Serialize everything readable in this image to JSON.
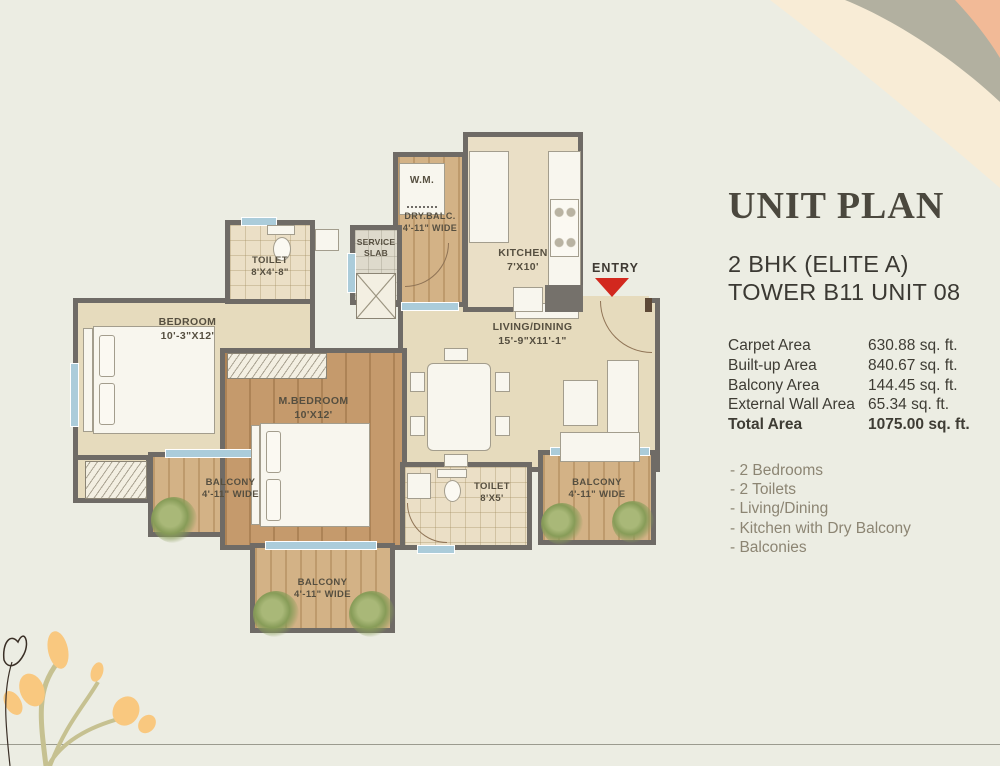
{
  "panel": {
    "title": "UNIT PLAN",
    "subtitle_line1": "2 BHK (ELITE A)",
    "subtitle_line2": "TOWER B11 UNIT 08",
    "areas": [
      {
        "label": "Carpet Area",
        "value": "630.88 sq. ft."
      },
      {
        "label": "Built-up Area",
        "value": "840.67 sq. ft."
      },
      {
        "label": "Balcony Area",
        "value": "144.45 sq. ft."
      },
      {
        "label": "External Wall Area",
        "value": "65.34 sq. ft."
      },
      {
        "label": "Total Area",
        "value": "1075.00 sq. ft."
      }
    ],
    "features": [
      "- 2 Bedrooms",
      "- 2 Toilets",
      "- Living/Dining",
      "- Kitchen with Dry Balcony",
      "- Balconies"
    ]
  },
  "plan": {
    "entry_label": "ENTRY",
    "rooms": {
      "bedroom": {
        "name": "BEDROOM",
        "size": "10'-3\"X12'"
      },
      "mbedroom": {
        "name": "M.BEDROOM",
        "size": "10'X12'"
      },
      "living": {
        "name": "LIVING/DINING",
        "size": "15'-9\"X11'-1\""
      },
      "kitchen": {
        "name": "KITCHEN",
        "size": "7'X10'"
      },
      "toilet1": {
        "name": "TOILET",
        "size": "8'X4'-8\""
      },
      "toilet2": {
        "name": "TOILET",
        "size": "8'X5'"
      },
      "drybalc": {
        "name": "DRY.BALC.",
        "size": "4'-11\" WIDE"
      },
      "service_line1": "SERVICE",
      "service_line2": "SLAB",
      "wm": "W.M.",
      "balcony_left": {
        "name": "BALCONY",
        "size": "4'-11\" WIDE"
      },
      "balcony_bottom": {
        "name": "BALCONY",
        "size": "4'-11\" WIDE"
      },
      "balcony_right": {
        "name": "BALCONY",
        "size": "4'-11\" WIDE"
      }
    }
  },
  "colors": {
    "background": "#ECEDE3",
    "wall": "#6F6B66",
    "floor_beige": "#E6DBBD",
    "wood": "#C59A6C",
    "window_glass": "#ABCCDA",
    "entry_red": "#D2281E",
    "title_text": "#4B483E",
    "feature_text": "#8C8573",
    "decor_cream": "#F8ECD6",
    "decor_sage": "#B2B0A0",
    "decor_salmon": "#F2BA97",
    "decor_petal": "#F9C87F"
  }
}
